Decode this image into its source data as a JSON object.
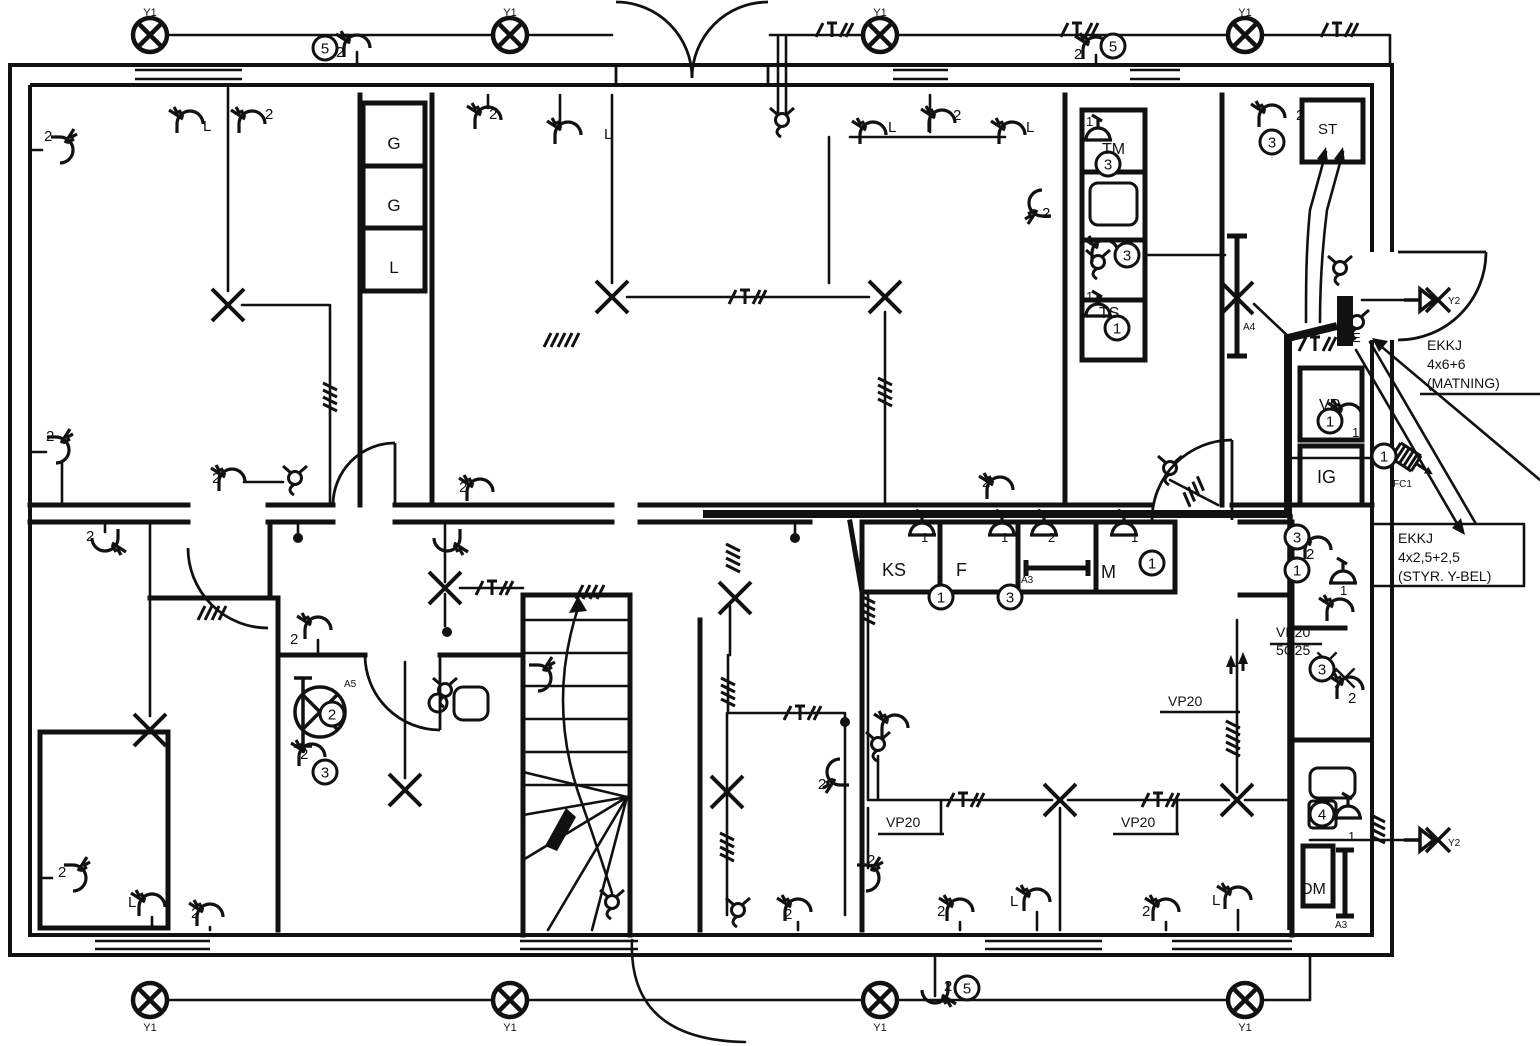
{
  "drawing_type": "electrical-installation-floor-plan",
  "colors": {
    "ink": "#111111",
    "paper": "#ffffff"
  },
  "cable_notes": {
    "feed": [
      "EKKJ",
      "4x6+6",
      "(MATNING)"
    ],
    "control": [
      "EKKJ",
      "4x2,5+2,5",
      "(STYR. Y-BEL)"
    ],
    "conduit_main": [
      "VP20",
      "5G25"
    ],
    "conduit": "VP20"
  },
  "labels": [
    {
      "t": "Y1",
      "x": 150,
      "y": 16,
      "fs": 11,
      "a": "m"
    },
    {
      "t": "Y1",
      "x": 510,
      "y": 16,
      "fs": 11,
      "a": "m"
    },
    {
      "t": "Y1",
      "x": 880,
      "y": 16,
      "fs": 11,
      "a": "m"
    },
    {
      "t": "Y1",
      "x": 1245,
      "y": 16,
      "fs": 11,
      "a": "m"
    },
    {
      "t": "Y1",
      "x": 150,
      "y": 1031,
      "fs": 11,
      "a": "m"
    },
    {
      "t": "Y1",
      "x": 510,
      "y": 1031,
      "fs": 11,
      "a": "m"
    },
    {
      "t": "Y1",
      "x": 880,
      "y": 1031,
      "fs": 11,
      "a": "m"
    },
    {
      "t": "Y1",
      "x": 1245,
      "y": 1031,
      "fs": 11,
      "a": "m"
    },
    {
      "t": "Y2",
      "x": 1448,
      "y": 304,
      "fs": 10
    },
    {
      "t": "Y2",
      "x": 1448,
      "y": 846,
      "fs": 10
    },
    {
      "t": "2",
      "x": 336,
      "y": 57
    },
    {
      "t": "2",
      "x": 1074,
      "y": 59
    },
    {
      "t": "2",
      "x": 944,
      "y": 991
    },
    {
      "t": "L",
      "x": 203,
      "y": 131
    },
    {
      "t": "2",
      "x": 265,
      "y": 119
    },
    {
      "t": "2",
      "x": 44,
      "y": 141
    },
    {
      "t": "2",
      "x": 46,
      "y": 441
    },
    {
      "t": "2",
      "x": 489,
      "y": 119
    },
    {
      "t": "L",
      "x": 604,
      "y": 139
    },
    {
      "t": "L",
      "x": 888,
      "y": 132
    },
    {
      "t": "2",
      "x": 953,
      "y": 120
    },
    {
      "t": "L",
      "x": 1026,
      "y": 132
    },
    {
      "t": "2",
      "x": 1042,
      "y": 218
    },
    {
      "t": "2",
      "x": 1296,
      "y": 120
    },
    {
      "t": "1",
      "x": 1086,
      "y": 126,
      "fs": 13
    },
    {
      "t": "1",
      "x": 1086,
      "y": 301,
      "fs": 13
    },
    {
      "t": "2",
      "x": 212,
      "y": 483
    },
    {
      "t": "2",
      "x": 459,
      "y": 492
    },
    {
      "t": "2",
      "x": 982,
      "y": 487
    },
    {
      "t": "2",
      "x": 86,
      "y": 541
    },
    {
      "t": "2",
      "x": 290,
      "y": 644
    },
    {
      "t": "2",
      "x": 300,
      "y": 759
    },
    {
      "t": "1",
      "x": 921,
      "y": 542,
      "fs": 13
    },
    {
      "t": "1",
      "x": 1001,
      "y": 542,
      "fs": 13
    },
    {
      "t": "2",
      "x": 1048,
      "y": 542,
      "fs": 13
    },
    {
      "t": "1",
      "x": 1131,
      "y": 542,
      "fs": 13
    },
    {
      "t": "KS",
      "x": 882,
      "y": 576,
      "fs": 18
    },
    {
      "t": "F",
      "x": 956,
      "y": 576,
      "fs": 18
    },
    {
      "t": "M",
      "x": 1101,
      "y": 578,
      "fs": 18
    },
    {
      "t": "A3",
      "x": 1021,
      "y": 583,
      "fs": 10
    },
    {
      "t": "G",
      "x": 394,
      "y": 149,
      "fs": 17,
      "a": "m"
    },
    {
      "t": "G",
      "x": 394,
      "y": 211,
      "fs": 17,
      "a": "m"
    },
    {
      "t": "L",
      "x": 394,
      "y": 273,
      "fs": 17,
      "a": "m"
    },
    {
      "t": "TM",
      "x": 1102,
      "y": 154,
      "fs": 16
    },
    {
      "t": "TS",
      "x": 1099,
      "y": 318,
      "fs": 16
    },
    {
      "t": "ST",
      "x": 1318,
      "y": 134,
      "fs": 15
    },
    {
      "t": "VP",
      "x": 1319,
      "y": 410,
      "fs": 16
    },
    {
      "t": "1",
      "x": 1352,
      "y": 437,
      "fs": 13
    },
    {
      "t": "IG",
      "x": 1317,
      "y": 483,
      "fs": 18
    },
    {
      "t": "DM",
      "x": 1301,
      "y": 894,
      "fs": 16
    },
    {
      "t": "A4",
      "x": 1243,
      "y": 330,
      "fs": 10
    },
    {
      "t": "A5",
      "x": 344,
      "y": 687,
      "fs": 10
    },
    {
      "t": "A3",
      "x": 1335,
      "y": 928,
      "fs": 10
    },
    {
      "t": "FC1",
      "x": 1393,
      "y": 487,
      "fs": 10
    },
    {
      "t": "E",
      "x": 1352,
      "y": 342,
      "fs": 13
    },
    {
      "t": "2",
      "x": 1306,
      "y": 559
    },
    {
      "t": "1",
      "x": 1340,
      "y": 595,
      "fs": 13
    },
    {
      "t": "2",
      "x": 1348,
      "y": 703
    },
    {
      "t": "1",
      "x": 1348,
      "y": 841,
      "fs": 13
    },
    {
      "t": "2",
      "x": 818,
      "y": 789
    },
    {
      "t": "2",
      "x": 784,
      "y": 919
    },
    {
      "t": "2",
      "x": 867,
      "y": 865
    },
    {
      "t": "2",
      "x": 937,
      "y": 916
    },
    {
      "t": "L",
      "x": 1010,
      "y": 906
    },
    {
      "t": "2",
      "x": 1142,
      "y": 916
    },
    {
      "t": "L",
      "x": 1212,
      "y": 905
    },
    {
      "t": "2",
      "x": 58,
      "y": 877
    },
    {
      "t": "L",
      "x": 128,
      "y": 907
    },
    {
      "t": "2",
      "x": 191,
      "y": 918
    },
    {
      "t": "VP20",
      "x": 886,
      "y": 827,
      "fs": 14,
      "u": [
        878,
        834,
        66
      ]
    },
    {
      "t": "VP20",
      "x": 1121,
      "y": 827,
      "fs": 14,
      "u": [
        1113,
        834,
        66
      ]
    },
    {
      "t": "VP20",
      "x": 1168,
      "y": 706,
      "fs": 14,
      "u": [
        1160,
        712,
        80
      ]
    },
    {
      "t": "VP20",
      "x": 1276,
      "y": 637,
      "fs": 14,
      "u": [
        1270,
        644,
        52
      ]
    },
    {
      "t": "5G25",
      "x": 1276,
      "y": 655,
      "fs": 14
    },
    {
      "t": "EKKJ",
      "x": 1427,
      "y": 350,
      "fs": 14
    },
    {
      "t": "4x6+6",
      "x": 1427,
      "y": 369,
      "fs": 14
    },
    {
      "t": "(MATNING)",
      "x": 1427,
      "y": 388,
      "fs": 14,
      "u": [
        1420,
        394,
        120
      ]
    },
    {
      "t": "EKKJ",
      "x": 1398,
      "y": 543,
      "fs": 14
    },
    {
      "t": "4x2,5+2,5",
      "x": 1398,
      "y": 562,
      "fs": 14
    },
    {
      "t": "(STYR. Y-BEL)",
      "x": 1398,
      "y": 581,
      "fs": 14
    }
  ],
  "circled": [
    {
      "n": "5",
      "x": 325,
      "y": 48
    },
    {
      "n": "5",
      "x": 1113,
      "y": 46
    },
    {
      "n": "5",
      "x": 967,
      "y": 988
    },
    {
      "n": "3",
      "x": 1272,
      "y": 142
    },
    {
      "n": "3",
      "x": 1108,
      "y": 164
    },
    {
      "n": "3",
      "x": 1127,
      "y": 255
    },
    {
      "n": "1",
      "x": 1117,
      "y": 328
    },
    {
      "n": "1",
      "x": 941,
      "y": 597
    },
    {
      "n": "3",
      "x": 1010,
      "y": 597
    },
    {
      "n": "1",
      "x": 1152,
      "y": 563
    },
    {
      "n": "1",
      "x": 1330,
      "y": 421
    },
    {
      "n": "1",
      "x": 1384,
      "y": 456
    },
    {
      "n": "3",
      "x": 1297,
      "y": 537
    },
    {
      "n": "1",
      "x": 1297,
      "y": 570
    },
    {
      "n": "3",
      "x": 1322,
      "y": 669
    },
    {
      "n": "2",
      "x": 332,
      "y": 714
    },
    {
      "n": "3",
      "x": 325,
      "y": 772
    },
    {
      "n": "4",
      "x": 1322,
      "y": 814
    }
  ],
  "symbols": [
    [
      "lampx",
      150,
      35
    ],
    [
      "lampx",
      510,
      35
    ],
    [
      "lampx",
      880,
      35
    ],
    [
      "lampx",
      1245,
      35
    ],
    [
      "lampx",
      150,
      1000
    ],
    [
      "lampx",
      510,
      1000
    ],
    [
      "lampx",
      880,
      1000
    ],
    [
      "lampx",
      1245,
      1000
    ],
    [
      "wlamp",
      1422,
      300
    ],
    [
      "wlamp",
      1422,
      840
    ],
    [
      "sw",
      357,
      46,
      0
    ],
    [
      "sw",
      1096,
      48,
      0
    ],
    [
      "sw",
      935,
      992,
      180
    ],
    [
      "sw",
      190,
      122,
      0
    ],
    [
      "sw",
      252,
      122,
      0
    ],
    [
      "sw",
      62,
      150,
      90
    ],
    [
      "sw",
      58,
      450,
      90
    ],
    [
      "sw",
      232,
      480,
      0
    ],
    [
      "sw",
      480,
      490,
      0
    ],
    [
      "sw",
      447,
      540,
      180
    ],
    [
      "sw",
      105,
      540,
      180
    ],
    [
      "sw",
      568,
      133,
      0
    ],
    [
      "sw",
      488,
      118,
      0
    ],
    [
      "sw",
      873,
      133,
      0
    ],
    [
      "sw",
      942,
      121,
      0
    ],
    [
      "sw",
      1012,
      133,
      0
    ],
    [
      "sw",
      1040,
      203,
      270
    ],
    [
      "sw",
      1272,
      116,
      0
    ],
    [
      "sw",
      1105,
      251,
      0
    ],
    [
      "sw",
      318,
      628,
      0
    ],
    [
      "sw",
      312,
      755,
      0
    ],
    [
      "sw",
      540,
      678,
      90
    ],
    [
      "sw",
      838,
      772,
      270
    ],
    [
      "sw",
      798,
      910,
      0
    ],
    [
      "sw",
      868,
      878,
      90
    ],
    [
      "sw",
      895,
      726,
      0
    ],
    [
      "sw",
      1318,
      548,
      0
    ],
    [
      "sw",
      1340,
      610,
      0
    ],
    [
      "sw",
      1350,
      688,
      0
    ],
    [
      "sw",
      1349,
      415,
      0
    ],
    [
      "sw",
      1000,
      488,
      0
    ],
    [
      "sw",
      960,
      910,
      0
    ],
    [
      "sw",
      1037,
      900,
      0
    ],
    [
      "sw",
      1166,
      910,
      0
    ],
    [
      "sw",
      1238,
      898,
      0
    ],
    [
      "sw",
      75,
      878,
      90
    ],
    [
      "sw",
      152,
      905,
      0
    ],
    [
      "sw",
      210,
      915,
      0
    ],
    [
      "so",
      1098,
      140,
      0
    ],
    [
      "so",
      1098,
      316,
      0
    ],
    [
      "so",
      922,
      535,
      0
    ],
    [
      "so",
      1002,
      535,
      0
    ],
    [
      "so",
      1044,
      535,
      0
    ],
    [
      "so",
      1124,
      535,
      0
    ],
    [
      "so",
      1343,
      583,
      0
    ],
    [
      "so",
      1348,
      818,
      0
    ],
    [
      "x",
      228,
      305
    ],
    [
      "x",
      612,
      297
    ],
    [
      "x",
      885,
      297
    ],
    [
      "x",
      1237,
      298
    ],
    [
      "x",
      445,
      588
    ],
    [
      "x",
      735,
      598
    ],
    [
      "x",
      150,
      730
    ],
    [
      "x",
      405,
      790
    ],
    [
      "x",
      727,
      792
    ],
    [
      "x",
      1060,
      800
    ],
    [
      "x",
      1237,
      800
    ],
    [
      "x",
      1327,
      662,
      0,
      0.6
    ],
    [
      "x",
      1345,
      678,
      0,
      0.6
    ],
    [
      "dot",
      298,
      538
    ],
    [
      "dot",
      795,
      538
    ],
    [
      "dot",
      845,
      722
    ],
    [
      "dot",
      447,
      632
    ],
    [
      "pend",
      782,
      120
    ],
    [
      "pend",
      295,
      478
    ],
    [
      "pend",
      445,
      690
    ],
    [
      "pend",
      1170,
      468
    ],
    [
      "pend",
      1340,
      268
    ],
    [
      "pend",
      612,
      902
    ],
    [
      "pend",
      738,
      910
    ],
    [
      "pend",
      878,
      744
    ],
    [
      "pend",
      1357,
      322
    ],
    [
      "pend",
      1098,
      262
    ],
    [
      "fan",
      320,
      712
    ],
    [
      "ht",
      832,
      30
    ],
    [
      "ht",
      1077,
      30
    ],
    [
      "ht",
      1337,
      30
    ],
    [
      "ht",
      745,
      297
    ],
    [
      "ht",
      1315,
      344
    ],
    [
      "ht",
      492,
      588
    ],
    [
      "ht",
      800,
      713
    ],
    [
      "ht",
      963,
      800
    ],
    [
      "ht",
      1158,
      800
    ],
    [
      "h4",
      885,
      390,
      90
    ],
    [
      "h4",
      330,
      395,
      90
    ],
    [
      "h4",
      210,
      613,
      0
    ],
    [
      "h4",
      1195,
      490,
      130
    ],
    [
      "h4",
      728,
      690,
      90
    ],
    [
      "h4",
      727,
      845,
      90
    ],
    [
      "h4",
      868,
      608,
      90
    ],
    [
      "h4",
      733,
      556,
      90
    ],
    [
      "h4",
      1378,
      827,
      90
    ],
    [
      "h4",
      588,
      592,
      0
    ],
    [
      "h5",
      560,
      340,
      0
    ],
    [
      "h5",
      1233,
      737,
      90
    ],
    [
      "arr",
      1231,
      658,
      0
    ],
    [
      "arr",
      1243,
      655,
      0
    ]
  ]
}
